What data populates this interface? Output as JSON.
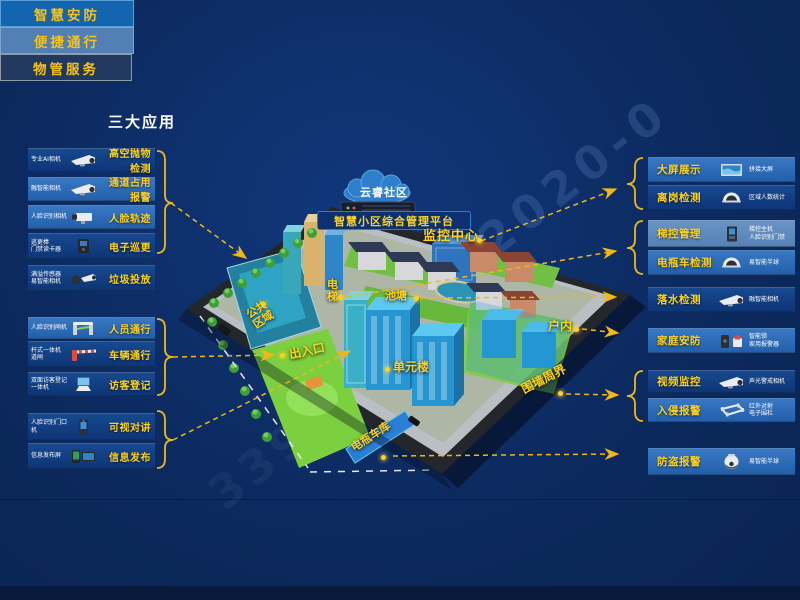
{
  "header": {
    "title": "三大应用",
    "apps": [
      {
        "label": "智慧安防"
      },
      {
        "label": "便捷通行"
      },
      {
        "label": "物管服务"
      }
    ]
  },
  "left_panels": [
    {
      "device_lines": [
        "专业AI相机"
      ],
      "feature": "高空抛物检测",
      "icon": "bullet-camera"
    },
    {
      "device_lines": [
        "融智能相机"
      ],
      "feature": "通道占用报警",
      "icon": "bullet-camera"
    },
    {
      "device_lines": [
        "人脸识别相机"
      ],
      "feature": "人脸轨迹",
      "icon": "box-camera"
    },
    {
      "device_lines": [
        "巡更棒",
        "门禁读卡器"
      ],
      "feature": "电子巡更",
      "icon": "card-reader"
    },
    {
      "device_lines": [
        "满溢传感器",
        "易智能相机"
      ],
      "feature": "垃圾投放",
      "icon": "sensor-camera"
    },
    {
      "device_lines": [
        "人脸识别闸机"
      ],
      "feature": "人员通行",
      "icon": "turnstile"
    },
    {
      "device_lines": [
        "杆式一体机",
        "道闸"
      ],
      "feature": "车辆通行",
      "icon": "barrier-gate"
    },
    {
      "device_lines": [
        "双面访客登记",
        "一体机"
      ],
      "feature": "访客登记",
      "icon": "visitor-kiosk"
    },
    {
      "device_lines": [
        "人脸识别门口",
        "机"
      ],
      "feature": "可视对讲",
      "icon": "door-station"
    },
    {
      "device_lines": [
        "信息发布屏"
      ],
      "feature": "信息发布",
      "icon": "info-screens"
    }
  ],
  "right_panels": [
    {
      "feature": "大屏展示",
      "device_lines": [
        "拼接大屏"
      ],
      "icon": "video-wall"
    },
    {
      "feature": "离岗检测",
      "device_lines": [
        "区域人数统计"
      ],
      "icon": "dome-camera"
    },
    {
      "feature": "梯控管理",
      "device_lines": [
        "梯控主机",
        "人脸识别门禁"
      ],
      "icon": "elevator-panel"
    },
    {
      "feature": "电瓶车检测",
      "device_lines": [
        "易智能半球"
      ],
      "icon": "dome-camera"
    },
    {
      "feature": "落水检测",
      "device_lines": [
        "融智能相机"
      ],
      "icon": "bullet-camera"
    },
    {
      "feature": "家庭安防",
      "device_lines": [
        "智能锁",
        "家用报警器"
      ],
      "icon": "lock-siren"
    },
    {
      "feature": "视频监控",
      "device_lines": [
        "声光警戒相机"
      ],
      "icon": "bullet-camera"
    },
    {
      "feature": "入侵报警",
      "device_lines": [
        "红外对射",
        "电子围栏"
      ],
      "icon": "perimeter-fence"
    },
    {
      "feature": "防盗报警",
      "device_lines": [
        "易智能半球"
      ],
      "icon": "turret-camera"
    }
  ],
  "map": {
    "cloud_label": "云睿社区",
    "platform_label": "智慧小区综合管理平台",
    "locations": {
      "monitor_center": "监控中心",
      "elevator": "电梯",
      "pond": "池塘",
      "public_area": "公共区域",
      "entrance": "出入口",
      "unit_building": "单元楼",
      "indoor": "户内",
      "perimeter": "围墙周界",
      "bike_garage": "电瓶车库"
    }
  },
  "watermarks": {
    "top_right": "2020-0",
    "bottom_left": "339"
  },
  "colors": {
    "accent_yellow": "#ffd21f",
    "background": "#0c2a5f",
    "app1_bg": "#1465af",
    "app2_bg": "#527fb4",
    "app3_bg": "#21395f"
  }
}
